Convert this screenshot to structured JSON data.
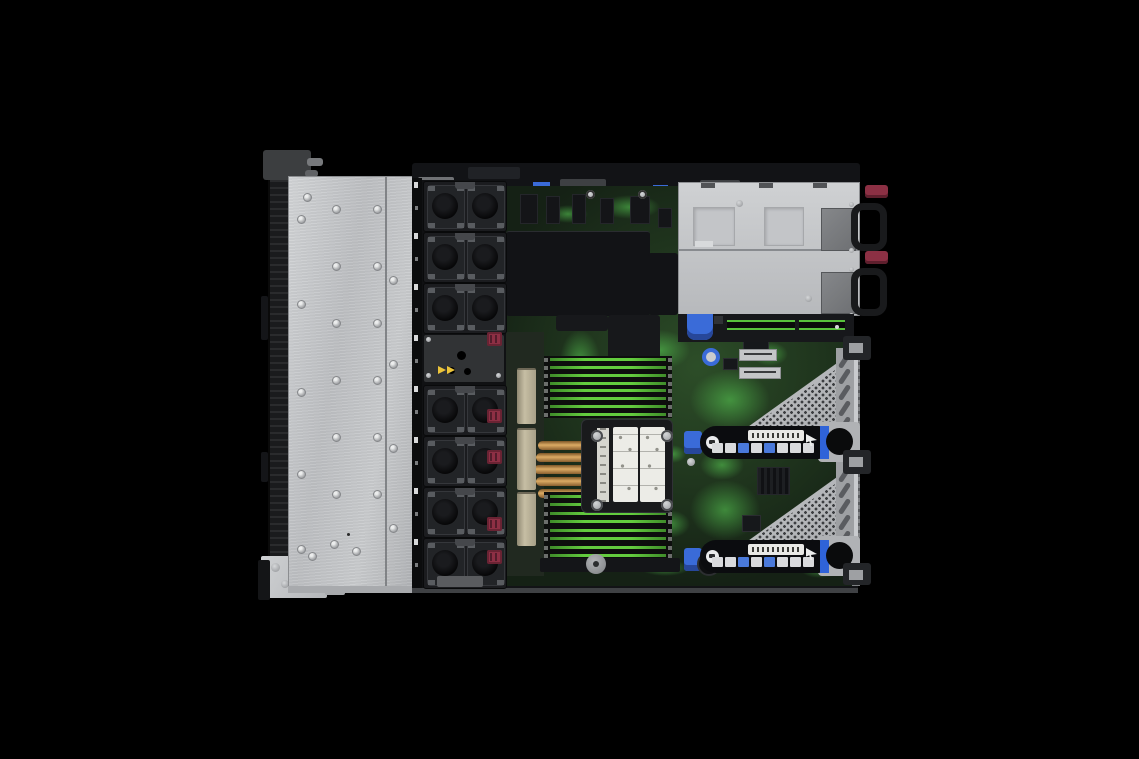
{
  "scene": {
    "type": "product-photograph",
    "subject": "Open-top 1U rack server interior viewed from above (cover removed)",
    "background_color": "#000000",
    "visible_text": "none-legible"
  },
  "colors": {
    "chassis_silver": "#c6c8ca",
    "bezel_black": "#1a1b1d",
    "pcb_green_dark": "#203320",
    "pcb_green_bright": "#5ad255",
    "dimm_slot_green": "#63cc3e",
    "fan_black": "#1b1c1f",
    "connector_maroon": "#8d2f44",
    "touchpoint_blue": "#3a6bd8",
    "heatpipe_copper": "#dcab64",
    "warning_yellow": "#ecc43a",
    "psu_handle_black": "#191a1c",
    "psu_release_tab": "#8c3044"
  },
  "components": {
    "front": {
      "mounting_ears": 2,
      "drive_bay_cover": {
        "material": "brushed-metal",
        "rivet_columns": 2
      }
    },
    "cooling": {
      "fan_slots": 8,
      "fan_modules_installed": 7,
      "fan_blank_position": 4,
      "fan_power_connectors": 5,
      "warning_arrows": 2
    },
    "processor": {
      "heatsinks": 1,
      "heat_pipes": 5,
      "corner_screws": 4,
      "instruction_label_cards": 2
    },
    "memory": {
      "dimm_banks": 2,
      "slots_per_bank": 8
    },
    "power": {
      "power_supplies": 2,
      "pull_handles": 2,
      "release_tabs": 2
    },
    "expansion": {
      "pcie_risers": 2,
      "rear_slot_vents_per_riser": 5,
      "label_icons_per_riser": 8,
      "edge_slots_below_psu": 2
    },
    "touchpoints_blue": [
      "top-edge-clips",
      "dimm-latch",
      "pcie-latch",
      "riser-thumbscrew",
      "riser-rail-strip"
    ]
  }
}
